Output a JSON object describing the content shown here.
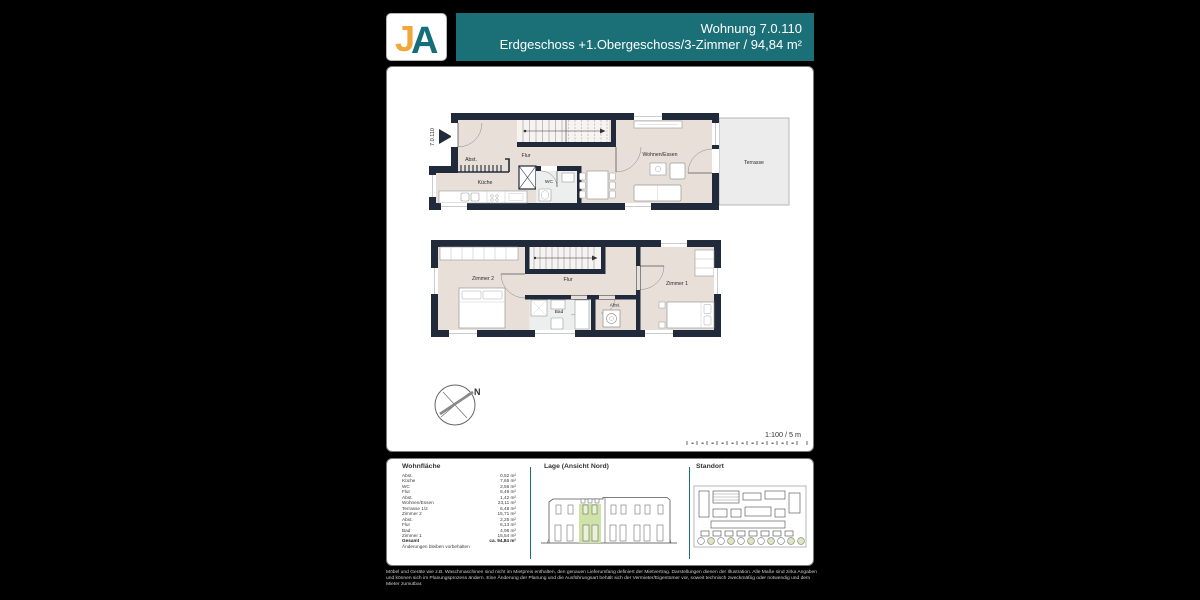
{
  "colors": {
    "accent_teal": "#1b7078",
    "logo_orange": "#f0a73b",
    "logo_teal": "#156f7a",
    "wall": "#202a3a",
    "floor": "#e8dfd8",
    "terrace": "#ececec",
    "highlight_green": "#cfe3a8"
  },
  "logo": {
    "letter_j": "J",
    "letter_a": "A"
  },
  "header": {
    "line1": "Wohnung 7.0.110",
    "line2": "Erdgeschoss +1.Obergeschoss/3-Zimmer /  94,84 m²"
  },
  "plan": {
    "unit_label": "7.0.110",
    "upper_labels": {
      "abst": "Abst.",
      "flur": "Flur",
      "wohnen": "Wohnen/Essen",
      "kueche": "Küche",
      "wc": "WC",
      "terrasse": "Terrasse"
    },
    "lower_labels": {
      "zimmer2": "Zimmer 2",
      "flur": "Flur",
      "zimmer1": "Zimmer 1",
      "bad": "Bad",
      "abst": "Abst."
    },
    "compass_label": "N",
    "scale_text": "1:100 / 5 m"
  },
  "area_table": {
    "title": "Wohnfläche",
    "rows": [
      {
        "label": "Abst.",
        "value": "0,52 m²"
      },
      {
        "label": "Küche",
        "value": "7,65 m²"
      },
      {
        "label": "WC",
        "value": "2,56 m²"
      },
      {
        "label": "Flur",
        "value": "8,49 m²"
      },
      {
        "label": "Abst.",
        "value": "1,42 m²"
      },
      {
        "label": "Wohnen/Essen",
        "value": "23,11 m²"
      },
      {
        "label": "Terrasse 1/2",
        "value": "6,48 m²"
      },
      {
        "label": "Zimmer 2",
        "value": "15,71 m²"
      },
      {
        "label": "Abst.",
        "value": "2,25 m²"
      },
      {
        "label": "Flur",
        "value": "6,13 m²"
      },
      {
        "label": "Bad",
        "value": "4,98 m²"
      },
      {
        "label": "Zimmer 1",
        "value": "15,54 m²"
      }
    ],
    "total": {
      "label": "Gesamt",
      "value": "ca. 94,84 m²"
    },
    "note": "Änderungen bleiben vorbehalten"
  },
  "sections": {
    "lage_title": "Lage (Ansicht Nord)",
    "standort_title": "Standort"
  },
  "disclaimer": "Möbel und Geräte wie z.B. Waschmaschinen sind nicht im Mietpreis enthalten, den genauen Lieferumfang definiert der Mietvertrag. Darstellungen dienen der Illustration. Alle Maße sind zirka Angaben und können sich im Planungsprozess ändern. Eine Änderung der Planung und die Ausführungsart behält sich der Vermieter/Eigentümer vor, soweit technisch zweckmäßig oder notwendig und dem Mieter zumutbar."
}
